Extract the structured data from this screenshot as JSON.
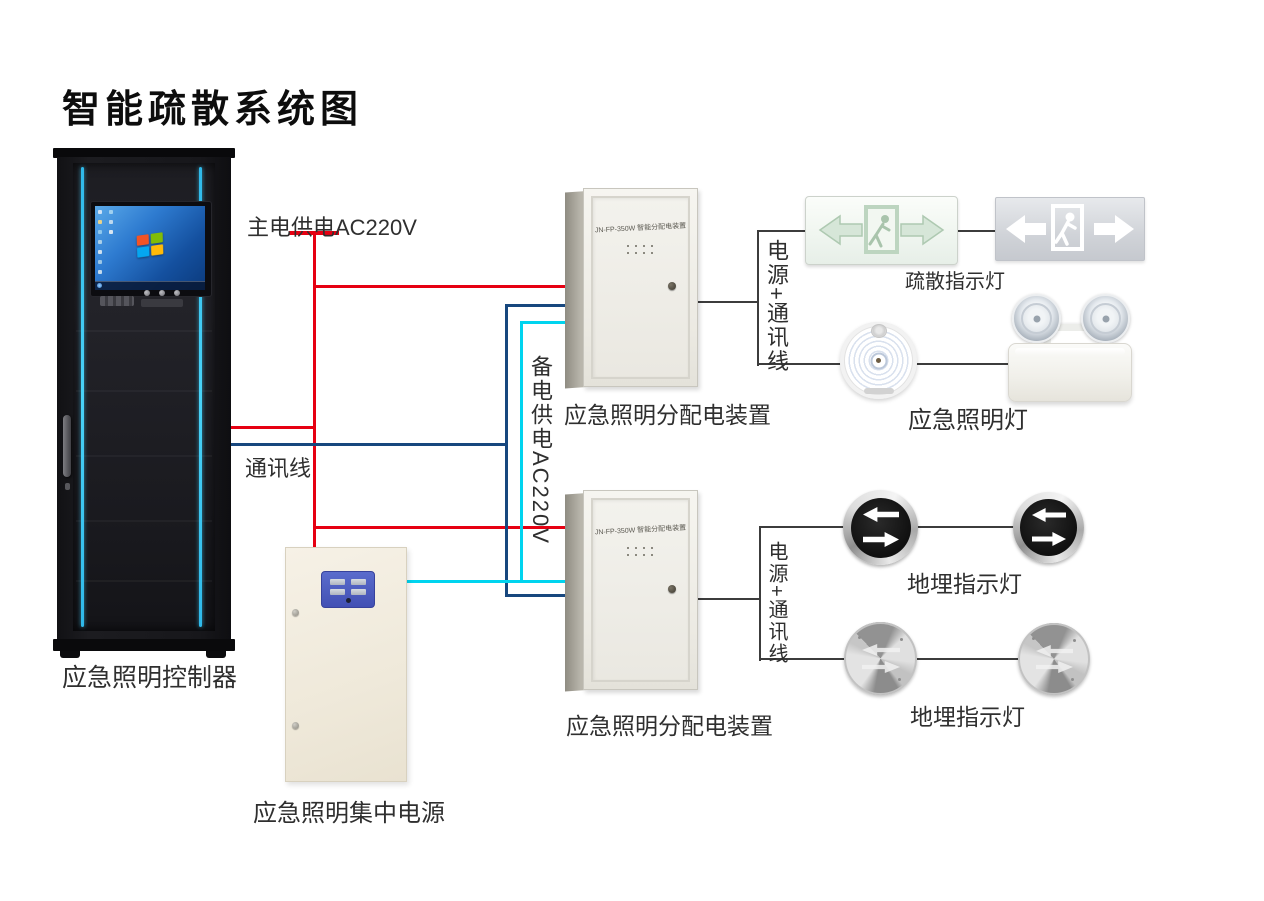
{
  "title": "智能疏散系统图",
  "colors": {
    "main_power_line": "#e60012",
    "comm_line": "#17477e",
    "backup_power_line": "#00d4ef",
    "device_line": "#3c3c3c",
    "cabinet_accent": "#2fb9ea",
    "panel_blue": "#4a5bbf"
  },
  "line_labels": {
    "main_power": "主电供电AC220V",
    "comm": "通讯线",
    "backup_power": "备电供电AC220V",
    "power_comm_upper": "电源+通讯线",
    "power_comm_lower": "电源+通讯线"
  },
  "devices": {
    "controller": {
      "label": "应急照明控制器"
    },
    "central_power": {
      "label": "应急照明集中电源"
    },
    "distribution_upper": {
      "label": "应急照明分配电装置",
      "model": "JN-FP-350W 智能分配电装置"
    },
    "distribution_lower": {
      "label": "应急照明分配电装置",
      "model": "JN-FP-350W 智能分配电装置"
    },
    "exit_signs": {
      "label": "疏散指示灯"
    },
    "emergency_lamp": {
      "label": "应急照明灯"
    },
    "buried_lights_upper": {
      "label": "地埋指示灯"
    },
    "buried_lights_lower": {
      "label": "地埋指示灯"
    }
  }
}
